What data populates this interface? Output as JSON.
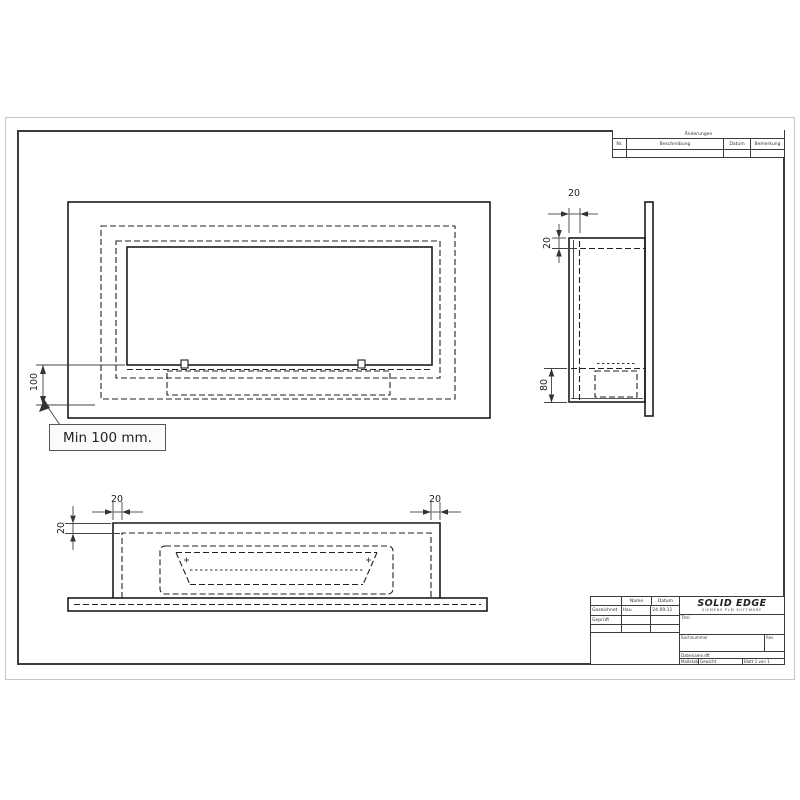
{
  "note": {
    "text": "Min 100 mm."
  },
  "dims": {
    "front_min_height": "100",
    "side_wall_gap": "20",
    "side_top_inset": "20",
    "side_burner_height": "80",
    "bottom_left_inset": "20",
    "bottom_right_inset": "20",
    "bottom_depth_inset": "20"
  },
  "rev_table": {
    "header": "Änderungen",
    "cols": [
      "Nr.",
      "Beschreibung",
      "Datum",
      "Bemerkung"
    ]
  },
  "titleblock": {
    "col_name": "Name",
    "col_date": "Datum",
    "row1_label": "Gezeichnet",
    "row1_name": "Hau",
    "row1_date": "24.09.11",
    "row2_label": "Geprüft",
    "logo": "SOLID EDGE",
    "logo_sub": "SIEMENS PLM SOFTWARE",
    "title_label": "Titel",
    "docnum_label": "Sachnummer",
    "rev_label": "Rev",
    "filename": "Dateiname.dft",
    "scale_label": "Maßstab",
    "weight_label": "Gewicht",
    "sheet_label": "Blatt 1 von 1"
  }
}
